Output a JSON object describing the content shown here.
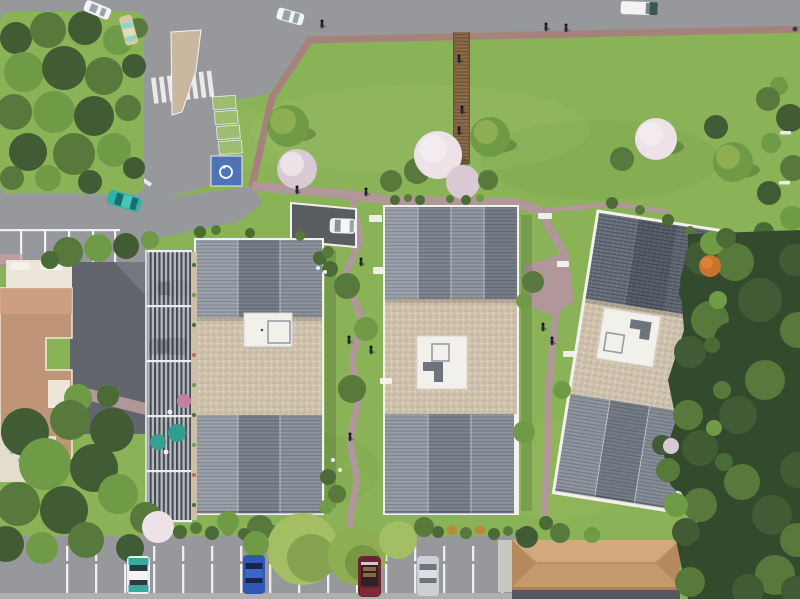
{
  "scene": {
    "type": "aerial-architectural-render",
    "description": "Bird's-eye 3D rendering of a residential development: three new apartment buildings with ribbed zinc roof wings and central gravel flat roofs with white rooftop access cabins, set in landscaped lawns with mauve footpaths, a timber boardwalk, a street with pedestrian crossing and traffic island, carports with parasols, parking areas with cars, existing tan-roofed buildings to the west and south, and dense woodland edges.",
    "buildings": [
      {
        "id": "residence-west",
        "roof": "ribbed zinc wings + gravel flat centre with white rooftop cabin"
      },
      {
        "id": "residence-center",
        "roof": "ribbed zinc wings + gravel flat centre with white rooftop cabin"
      },
      {
        "id": "residence-east",
        "roof": "dark tiled wing + gravel flat centre + ribbed zinc wing, tilted footprint, east balconies"
      },
      {
        "id": "existing-building-west",
        "roof": "tan stepped roof with cream trim"
      },
      {
        "id": "existing-building-south",
        "roof": "long tan hipped roof"
      }
    ],
    "vehicles": [
      {
        "id": "sedan-top-left",
        "color_hex": "#f2f3f4",
        "location": "top road west"
      },
      {
        "id": "hatchback-beige",
        "color_hex": "#d9caa2",
        "location": "west street"
      },
      {
        "id": "sedan-top-center",
        "color_hex": "#f2f3f4",
        "location": "top road"
      },
      {
        "id": "van-top-right",
        "color_hex": "#f2f3f4",
        "location": "top road east"
      },
      {
        "id": "car-teal-entrance",
        "color_hex": "#2fb3a8",
        "location": "site entrance"
      },
      {
        "id": "car-ramp",
        "color_hex": "#eef0f1",
        "location": "underground parking ramp"
      },
      {
        "id": "car-carport-1",
        "color_hex": "#aeb2b7",
        "location": "carports"
      },
      {
        "id": "car-carport-2",
        "color_hex": "#9ea2a7",
        "location": "carports"
      },
      {
        "id": "car-teal-south",
        "color_hex": "#3aa99e",
        "location": "south parking"
      },
      {
        "id": "car-blue-south",
        "color_hex": "#2f57b8",
        "location": "south parking"
      },
      {
        "id": "car-red-convertible-south",
        "color_hex": "#6b2330",
        "location": "south parking"
      },
      {
        "id": "car-silver-south",
        "color_hex": "#ccd0d4",
        "location": "south parking"
      }
    ],
    "site_features": [
      "pedestrian-crossing",
      "traffic-island",
      "accessible-parking-bay",
      "green-parking-bays",
      "timber-boardwalk",
      "footpaths",
      "benches",
      "carports-with-pergolas",
      "underground-parking-ramp",
      "lawns",
      "flowering-trees",
      "woodland-edge",
      "garden-hedge",
      "parasols"
    ],
    "people_count": 14
  },
  "palette": {
    "lawn": "#8ab257",
    "lawnLight": "#a0c46b",
    "lawnDark": "#6d9a44",
    "road": "#97989c",
    "path": "#b1979a",
    "sidewalk": "#a5837c",
    "marking": "#f0f2f2",
    "gravel": "#cec2ad",
    "boardwalk": "#8a6a4a",
    "tw": "#334a2d",
    "td": "#415c34",
    "tm": "#58793c",
    "tg": "#6f9a46",
    "tl": "#8fae52",
    "tb": "#a4bf63",
    "th": "#4a6b35",
    "bl": "#d9c9d2",
    "bll": "#ece2e7",
    "ta": "#b98a3e",
    "ribLight": "#9aa1ab",
    "ribMid": "#767e89",
    "slateDark": "#545c68",
    "bldgWhite": "#f2f1ec",
    "penthouse": "#f1f0eb",
    "penthouseGray": "#6e747c",
    "tanRoof": "#c59b6e",
    "tanRoofLight": "#d1a97c",
    "tanRoofDark": "#b68a5e",
    "existTan": "#c09477",
    "cream": "#e9e5d9",
    "carWhite": "#f2f3f4",
    "carTeal": "#2fb3a8",
    "carBlue": "#2f57b8",
    "carSilver": "#ccd0d4",
    "carRed": "#6b2330",
    "carGray": "#aeb2b7",
    "carBeige": "#d9caa2",
    "vanGreen": "#3c5a4c",
    "handicap": "#4e74b5",
    "ecoSpot": "#9dbd72",
    "parasolTeal": "#2f9e8f",
    "parasolPink": "#c77f9e",
    "orangeTree": "#c8732e"
  }
}
